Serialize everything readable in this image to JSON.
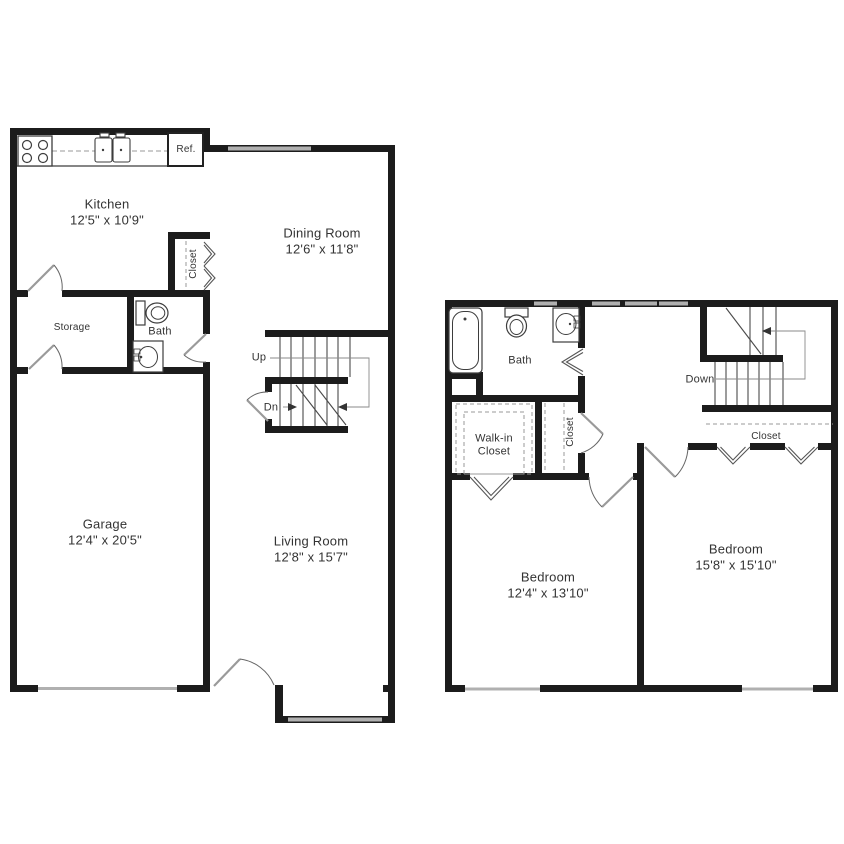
{
  "floor1": {
    "kitchen": {
      "name": "Kitchen",
      "dims": "12'5\" x 10'9\""
    },
    "dining_room": {
      "name": "Dining Room",
      "dims": "12'6\" x 11'8\""
    },
    "storage": {
      "name": "Storage"
    },
    "bath": {
      "name": "Bath"
    },
    "garage": {
      "name": "Garage",
      "dims": "12'4\" x 20'5\""
    },
    "living_room": {
      "name": "Living Room",
      "dims": "12'8\" x 15'7\""
    },
    "closet": {
      "name": "Closet"
    },
    "refrigerator": {
      "name": "Ref."
    },
    "stairs": {
      "up": "Up",
      "down": "Dn"
    }
  },
  "floor2": {
    "bath": {
      "name": "Bath"
    },
    "walk_in_closet": {
      "line1": "Walk-in",
      "line2": "Closet"
    },
    "hall_closet": {
      "name": "Closet"
    },
    "bedroom_closet": {
      "name": "Closet"
    },
    "bedroom_left": {
      "name": "Bedroom",
      "dims": "12'4\" x 13'10\""
    },
    "bedroom_right": {
      "name": "Bedroom",
      "dims": "15'8\" x 15'10\""
    },
    "stairs": {
      "down": "Down"
    }
  },
  "colors": {
    "wall": "#1c1c1c",
    "fixture_line": "#3d3d3d",
    "window_gray": "#b0b0b0",
    "text": "#333333",
    "background": "#ffffff"
  }
}
